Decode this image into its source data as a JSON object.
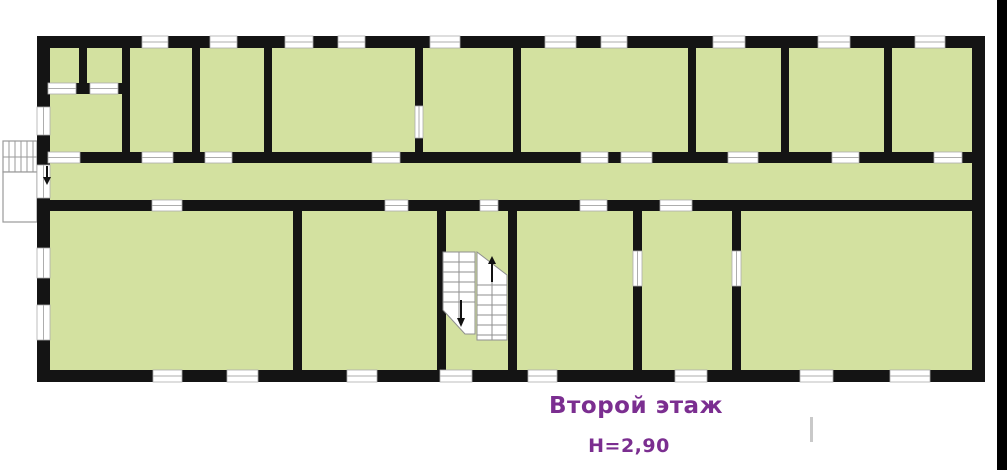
{
  "labels": {
    "floor_title": "Второй этаж",
    "floor_height": "Н=2,90"
  },
  "colors": {
    "wall": "#141414",
    "room_fill": "#d3e1a0",
    "accent_text": "#7b2e90",
    "opening_line": "#adadad",
    "opening_fill": "#ffffff",
    "exterior_stair_line": "#9a9a9a",
    "stair_line": "#8f8f8f",
    "arrow": "#111111",
    "edge_strip": "#000000",
    "stray_mark": "#c9c9c9",
    "canvas": "#ffffff"
  },
  "plan": {
    "canvas": {
      "w": 1007,
      "h": 470
    },
    "building": {
      "x": 37,
      "y": 36,
      "w": 948,
      "h": 346
    },
    "walls": [
      {
        "x": 37,
        "y": 36,
        "w": 948,
        "h": 12
      },
      {
        "x": 37,
        "y": 370,
        "w": 948,
        "h": 12
      },
      {
        "x": 37,
        "y": 36,
        "w": 13,
        "h": 346
      },
      {
        "x": 972,
        "y": 36,
        "w": 13,
        "h": 346
      },
      {
        "x": 37,
        "y": 152,
        "w": 948,
        "h": 11
      },
      {
        "x": 37,
        "y": 200,
        "w": 948,
        "h": 11
      },
      {
        "x": 79,
        "y": 36,
        "w": 8,
        "h": 52
      },
      {
        "x": 37,
        "y": 83,
        "w": 91,
        "h": 11
      },
      {
        "x": 122,
        "y": 36,
        "w": 8,
        "h": 127
      },
      {
        "x": 192,
        "y": 36,
        "w": 8,
        "h": 127
      },
      {
        "x": 264,
        "y": 36,
        "w": 8,
        "h": 127
      },
      {
        "x": 415,
        "y": 36,
        "w": 8,
        "h": 70
      },
      {
        "x": 415,
        "y": 138,
        "w": 8,
        "h": 25
      },
      {
        "x": 513,
        "y": 36,
        "w": 8,
        "h": 127
      },
      {
        "x": 688,
        "y": 36,
        "w": 8,
        "h": 127
      },
      {
        "x": 781,
        "y": 36,
        "w": 8,
        "h": 127
      },
      {
        "x": 884,
        "y": 36,
        "w": 8,
        "h": 127
      },
      {
        "x": 293,
        "y": 200,
        "w": 9,
        "h": 182
      },
      {
        "x": 437,
        "y": 200,
        "w": 9,
        "h": 182
      },
      {
        "x": 508,
        "y": 200,
        "w": 9,
        "h": 182
      },
      {
        "x": 633,
        "y": 200,
        "w": 9,
        "h": 51
      },
      {
        "x": 633,
        "y": 286,
        "w": 9,
        "h": 96
      },
      {
        "x": 732,
        "y": 200,
        "w": 9,
        "h": 51
      },
      {
        "x": 732,
        "y": 286,
        "w": 9,
        "h": 96
      }
    ],
    "openings": [
      {
        "x": 142,
        "y": 36,
        "w": 26,
        "h": 12,
        "t": "window"
      },
      {
        "x": 210,
        "y": 36,
        "w": 27,
        "h": 12,
        "t": "window"
      },
      {
        "x": 285,
        "y": 36,
        "w": 28,
        "h": 12,
        "t": "window"
      },
      {
        "x": 338,
        "y": 36,
        "w": 27,
        "h": 12,
        "t": "window"
      },
      {
        "x": 430,
        "y": 36,
        "w": 30,
        "h": 12,
        "t": "window"
      },
      {
        "x": 545,
        "y": 36,
        "w": 31,
        "h": 12,
        "t": "window"
      },
      {
        "x": 601,
        "y": 36,
        "w": 26,
        "h": 12,
        "t": "window"
      },
      {
        "x": 713,
        "y": 36,
        "w": 32,
        "h": 12,
        "t": "window"
      },
      {
        "x": 818,
        "y": 36,
        "w": 32,
        "h": 12,
        "t": "window"
      },
      {
        "x": 915,
        "y": 36,
        "w": 30,
        "h": 12,
        "t": "window"
      },
      {
        "x": 48,
        "y": 152,
        "w": 32,
        "h": 11,
        "t": "door"
      },
      {
        "x": 142,
        "y": 152,
        "w": 31,
        "h": 11,
        "t": "door"
      },
      {
        "x": 205,
        "y": 152,
        "w": 27,
        "h": 11,
        "t": "door"
      },
      {
        "x": 372,
        "y": 152,
        "w": 28,
        "h": 11,
        "t": "door"
      },
      {
        "x": 581,
        "y": 152,
        "w": 27,
        "h": 11,
        "t": "door"
      },
      {
        "x": 621,
        "y": 152,
        "w": 31,
        "h": 11,
        "t": "door"
      },
      {
        "x": 728,
        "y": 152,
        "w": 30,
        "h": 11,
        "t": "door"
      },
      {
        "x": 832,
        "y": 152,
        "w": 27,
        "h": 11,
        "t": "door"
      },
      {
        "x": 934,
        "y": 152,
        "w": 28,
        "h": 11,
        "t": "door"
      },
      {
        "x": 152,
        "y": 200,
        "w": 30,
        "h": 11,
        "t": "door"
      },
      {
        "x": 385,
        "y": 200,
        "w": 23,
        "h": 11,
        "t": "door"
      },
      {
        "x": 480,
        "y": 200,
        "w": 18,
        "h": 11,
        "t": "door"
      },
      {
        "x": 580,
        "y": 200,
        "w": 27,
        "h": 11,
        "t": "door"
      },
      {
        "x": 660,
        "y": 200,
        "w": 32,
        "h": 11,
        "t": "door"
      },
      {
        "x": 153,
        "y": 370,
        "w": 29,
        "h": 12,
        "t": "window"
      },
      {
        "x": 227,
        "y": 370,
        "w": 31,
        "h": 12,
        "t": "window"
      },
      {
        "x": 347,
        "y": 370,
        "w": 30,
        "h": 12,
        "t": "window"
      },
      {
        "x": 440,
        "y": 370,
        "w": 32,
        "h": 12,
        "t": "window"
      },
      {
        "x": 528,
        "y": 370,
        "w": 29,
        "h": 12,
        "t": "window"
      },
      {
        "x": 675,
        "y": 370,
        "w": 32,
        "h": 12,
        "t": "window"
      },
      {
        "x": 800,
        "y": 370,
        "w": 33,
        "h": 12,
        "t": "window"
      },
      {
        "x": 890,
        "y": 370,
        "w": 40,
        "h": 12,
        "t": "window"
      },
      {
        "x": 37,
        "y": 107,
        "w": 13,
        "h": 28,
        "t": "window"
      },
      {
        "x": 37,
        "y": 165,
        "w": 13,
        "h": 33,
        "t": "door"
      },
      {
        "x": 37,
        "y": 248,
        "w": 13,
        "h": 30,
        "t": "window"
      },
      {
        "x": 37,
        "y": 305,
        "w": 13,
        "h": 35,
        "t": "window"
      },
      {
        "x": 48,
        "y": 83,
        "w": 28,
        "h": 11,
        "t": "door"
      },
      {
        "x": 90,
        "y": 83,
        "w": 28,
        "h": 11,
        "t": "door"
      },
      {
        "x": 415,
        "y": 106,
        "w": 8,
        "h": 32,
        "t": "door"
      },
      {
        "x": 633,
        "y": 251,
        "w": 9,
        "h": 35,
        "t": "door"
      },
      {
        "x": 732,
        "y": 251,
        "w": 9,
        "h": 35,
        "t": "door"
      }
    ],
    "interior_stairs": {
      "flights": [
        {
          "poly": "443,252 475,252 475,334 465,334 443,310",
          "lines": [
            [
              443,
              262,
              475,
              262
            ],
            [
              443,
              272,
              475,
              272
            ],
            [
              443,
              282,
              475,
              282
            ],
            [
              443,
              292,
              475,
              292
            ],
            [
              443,
              302,
              475,
              302
            ],
            [
              459,
              252,
              459,
              320
            ]
          ]
        },
        {
          "poly": "477,252 507,275 507,340 477,340",
          "lines": [
            [
              477,
              285,
              507,
              285
            ],
            [
              477,
              295,
              507,
              295
            ],
            [
              477,
              305,
              507,
              305
            ],
            [
              477,
              315,
              507,
              315
            ],
            [
              477,
              325,
              507,
              325
            ],
            [
              477,
              335,
              507,
              335
            ],
            [
              492,
              268,
              492,
              340
            ]
          ]
        }
      ],
      "arrows": [
        {
          "stem": [
            461,
            300,
            461,
            318
          ],
          "head": "457,318 465,318 461,327",
          "dir": "down"
        },
        {
          "stem": [
            492,
            282,
            492,
            264
          ],
          "head": "488,264 496,264 492,256",
          "dir": "up"
        }
      ]
    },
    "exterior_stair": {
      "boxes": [
        {
          "x": 3,
          "y": 141,
          "w": 34,
          "h": 31
        },
        {
          "x": 3,
          "y": 172,
          "w": 34,
          "h": 50
        }
      ],
      "lines": [
        [
          9,
          141,
          9,
          172
        ],
        [
          15,
          141,
          15,
          172
        ],
        [
          21,
          141,
          21,
          172
        ],
        [
          27,
          141,
          27,
          172
        ],
        [
          33,
          141,
          33,
          172
        ],
        [
          3,
          157,
          37,
          157
        ]
      ],
      "arrow": {
        "stem": [
          47,
          166,
          47,
          177
        ],
        "head": "43,177 51,177 47,185",
        "dir": "down"
      }
    },
    "edge_strip": {
      "x": 997,
      "y": 0,
      "w": 10,
      "h": 470
    },
    "stray_mark": {
      "x": 810,
      "y": 417,
      "w": 3,
      "h": 25
    }
  }
}
